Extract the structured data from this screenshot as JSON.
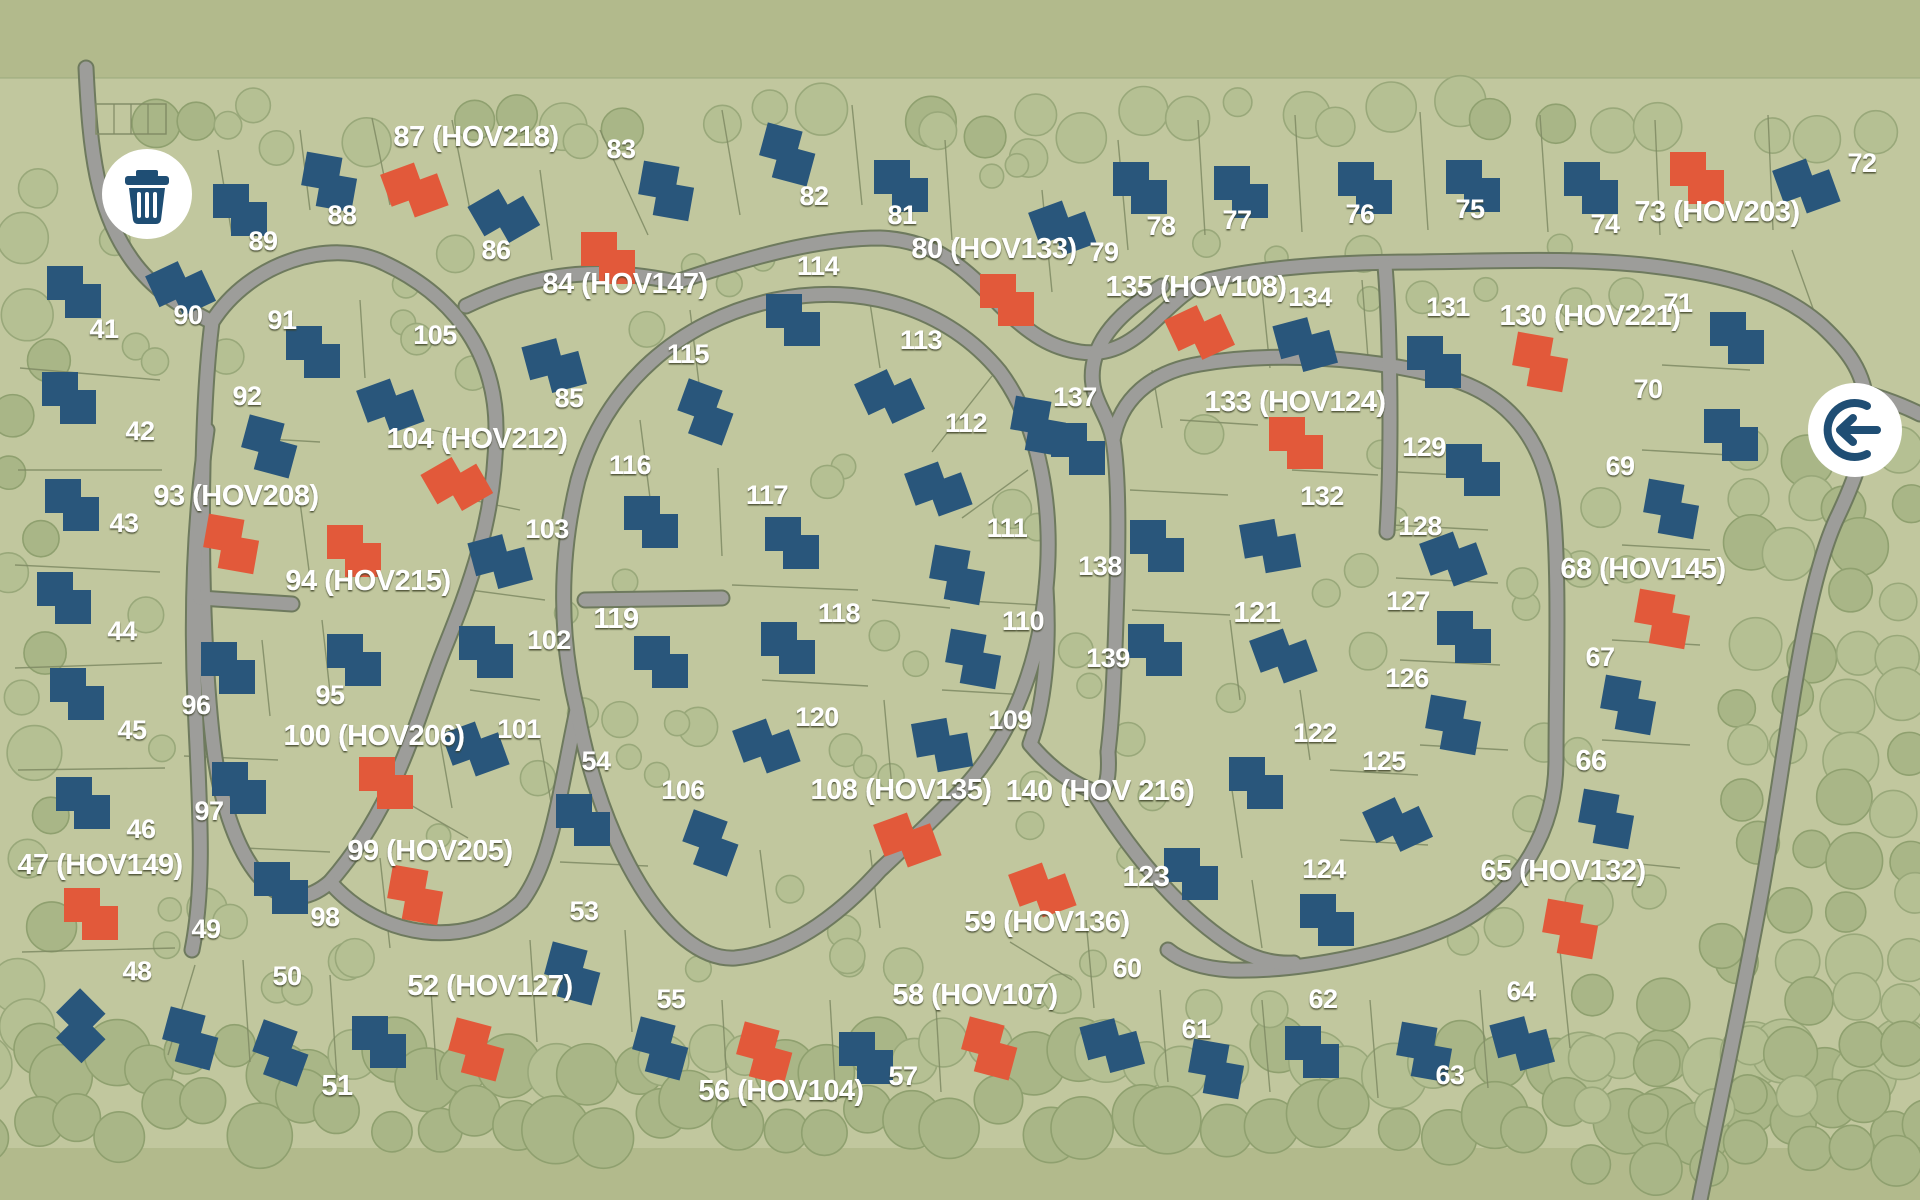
{
  "map_title": "community-site-map",
  "palette": {
    "band_green": "#b2ba8c",
    "land_green": "#c1c79e",
    "parcel_line": "#7f8a64",
    "road_fill": "#9d9d9a",
    "road_casing": "#6e7a5e",
    "house_blue": "#29567b",
    "house_orange": "#e2593a",
    "label_color": "#ffffff",
    "icon_blue": "#1f4e74",
    "icon_circle": "#ffffff",
    "tree_fill": "#b5c093",
    "tree_stroke": "#99a87a",
    "forest_fill": "#a9b687",
    "forest_stroke": "#8fa06f"
  },
  "icons": [
    {
      "name": "trash-icon",
      "x": 147,
      "y": 194,
      "r": 45
    },
    {
      "name": "exit-icon",
      "x": 1855,
      "y": 430,
      "r": 47
    }
  ],
  "lots": [
    {
      "n": "41",
      "bold": false,
      "lx": 104,
      "ly": 338,
      "hx": 80,
      "hy": 292,
      "hr": 0,
      "hc": "blue"
    },
    {
      "n": "42",
      "bold": false,
      "lx": 140,
      "ly": 440,
      "hx": 75,
      "hy": 398,
      "hr": 0,
      "hc": "blue"
    },
    {
      "n": "43",
      "bold": false,
      "lx": 124,
      "ly": 532,
      "hx": 78,
      "hy": 505,
      "hr": 0,
      "hc": "blue"
    },
    {
      "n": "44",
      "bold": false,
      "lx": 122,
      "ly": 640,
      "hx": 70,
      "hy": 598,
      "hr": 0,
      "hc": "blue"
    },
    {
      "n": "45",
      "bold": false,
      "lx": 132,
      "ly": 739,
      "hx": 83,
      "hy": 694,
      "hr": 0,
      "hc": "blue"
    },
    {
      "n": "46",
      "bold": false,
      "lx": 141,
      "ly": 838,
      "hx": 89,
      "hy": 803,
      "hr": 0,
      "hc": "blue"
    },
    {
      "n": "47 (HOV149)",
      "bold": true,
      "lx": 100,
      "ly": 874,
      "hx": 97,
      "hy": 914,
      "hr": 0,
      "hc": "orange"
    },
    {
      "n": "48",
      "bold": false,
      "lx": 137,
      "ly": 980,
      "hx": 85,
      "hy": 1030,
      "hr": 45,
      "hc": "blue"
    },
    {
      "n": "49",
      "bold": false,
      "lx": 206,
      "ly": 938,
      "hx": 196,
      "hy": 1040,
      "hr": 15,
      "hc": "blue"
    },
    {
      "n": "50",
      "bold": false,
      "lx": 287,
      "ly": 985,
      "hx": 286,
      "hy": 1055,
      "hr": 20,
      "hc": "blue"
    },
    {
      "n": "51",
      "bold": true,
      "lx": 337,
      "ly": 1095,
      "hx": 385,
      "hy": 1042,
      "hr": 0,
      "hc": "blue"
    },
    {
      "n": "52 (HOV127)",
      "bold": true,
      "lx": 490,
      "ly": 995,
      "hx": 482,
      "hy": 1051,
      "hr": 15,
      "hc": "orange"
    },
    {
      "n": "53",
      "bold": false,
      "lx": 584,
      "ly": 920,
      "hx": 578,
      "hy": 975,
      "hr": 15,
      "hc": "blue"
    },
    {
      "n": "54",
      "bold": false,
      "lx": 596,
      "ly": 770,
      "hx": 589,
      "hy": 820,
      "hr": 0,
      "hc": "blue"
    },
    {
      "n": "55",
      "bold": false,
      "lx": 671,
      "ly": 1008,
      "hx": 666,
      "hy": 1050,
      "hr": 15,
      "hc": "blue"
    },
    {
      "n": "56 (HOV104)",
      "bold": true,
      "lx": 781,
      "ly": 1100,
      "hx": 770,
      "hy": 1055,
      "hr": 15,
      "hc": "orange"
    },
    {
      "n": "57",
      "bold": false,
      "lx": 903,
      "ly": 1085,
      "hx": 872,
      "hy": 1058,
      "hr": 0,
      "hc": "blue"
    },
    {
      "n": "58 (HOV107)",
      "bold": true,
      "lx": 975,
      "ly": 1004,
      "hx": 995,
      "hy": 1050,
      "hr": 15,
      "hc": "orange"
    },
    {
      "n": "59 (HOV136)",
      "bold": true,
      "lx": 1047,
      "ly": 931,
      "hx": 1048,
      "hy": 888,
      "hr": -20,
      "hc": "orange"
    },
    {
      "n": "60",
      "bold": false,
      "lx": 1127,
      "ly": 977,
      "hx": 1118,
      "hy": 1044,
      "hr": -15,
      "hc": "blue"
    },
    {
      "n": "61",
      "bold": false,
      "lx": 1196,
      "ly": 1038,
      "hx": 1222,
      "hy": 1070,
      "hr": 10,
      "hc": "blue"
    },
    {
      "n": "62",
      "bold": false,
      "lx": 1323,
      "ly": 1008,
      "hx": 1318,
      "hy": 1052,
      "hr": 0,
      "hc": "blue"
    },
    {
      "n": "63",
      "bold": false,
      "lx": 1450,
      "ly": 1084,
      "hx": 1430,
      "hy": 1053,
      "hr": 10,
      "hc": "blue"
    },
    {
      "n": "64",
      "bold": false,
      "lx": 1521,
      "ly": 1000,
      "hx": 1528,
      "hy": 1042,
      "hr": -15,
      "hc": "blue"
    },
    {
      "n": "65 (HOV132)",
      "bold": true,
      "lx": 1563,
      "ly": 880,
      "hx": 1576,
      "hy": 930,
      "hr": 10,
      "hc": "orange"
    },
    {
      "n": "66",
      "bold": true,
      "lx": 1591,
      "ly": 770,
      "hx": 1612,
      "hy": 820,
      "hr": 10,
      "hc": "blue"
    },
    {
      "n": "67",
      "bold": false,
      "lx": 1600,
      "ly": 666,
      "hx": 1634,
      "hy": 706,
      "hr": 10,
      "hc": "blue"
    },
    {
      "n": "68 (HOV145)",
      "bold": true,
      "lx": 1643,
      "ly": 578,
      "hx": 1668,
      "hy": 620,
      "hr": 10,
      "hc": "orange"
    },
    {
      "n": "69",
      "bold": false,
      "lx": 1620,
      "ly": 475,
      "hx": 1677,
      "hy": 510,
      "hr": 10,
      "hc": "blue"
    },
    {
      "n": "70",
      "bold": false,
      "lx": 1648,
      "ly": 398,
      "hx": 1737,
      "hy": 435,
      "hr": 0,
      "hc": "blue"
    },
    {
      "n": "71",
      "bold": false,
      "lx": 1678,
      "ly": 312,
      "hx": 1743,
      "hy": 338,
      "hr": 0,
      "hc": "blue"
    },
    {
      "n": "72",
      "bold": false,
      "lx": 1862,
      "ly": 172,
      "hx": 1812,
      "hy": 184,
      "hr": -20,
      "hc": "blue"
    },
    {
      "n": "73 (HOV203)",
      "bold": true,
      "lx": 1717,
      "ly": 221,
      "hx": 1703,
      "hy": 178,
      "hr": 0,
      "hc": "orange"
    },
    {
      "n": "74",
      "bold": false,
      "lx": 1605,
      "ly": 233,
      "hx": 1597,
      "hy": 188,
      "hr": 0,
      "hc": "blue"
    },
    {
      "n": "75",
      "bold": false,
      "lx": 1470,
      "ly": 218,
      "hx": 1479,
      "hy": 186,
      "hr": 0,
      "hc": "blue"
    },
    {
      "n": "76",
      "bold": false,
      "lx": 1360,
      "ly": 223,
      "hx": 1371,
      "hy": 188,
      "hr": 0,
      "hc": "blue"
    },
    {
      "n": "77",
      "bold": false,
      "lx": 1237,
      "ly": 229,
      "hx": 1247,
      "hy": 192,
      "hr": 0,
      "hc": "blue"
    },
    {
      "n": "78",
      "bold": false,
      "lx": 1161,
      "ly": 235,
      "hx": 1146,
      "hy": 188,
      "hr": 0,
      "hc": "blue"
    },
    {
      "n": "79",
      "bold": false,
      "lx": 1104,
      "ly": 261,
      "hx": 1068,
      "hy": 226,
      "hr": -20,
      "hc": "blue"
    },
    {
      "n": "80 (HOV133)",
      "bold": true,
      "lx": 994,
      "ly": 258,
      "hx": 1013,
      "hy": 300,
      "hr": 0,
      "hc": "orange"
    },
    {
      "n": "81",
      "bold": false,
      "lx": 902,
      "ly": 224,
      "hx": 907,
      "hy": 186,
      "hr": 0,
      "hc": "blue"
    },
    {
      "n": "82",
      "bold": false,
      "lx": 814,
      "ly": 205,
      "hx": 793,
      "hy": 156,
      "hr": 15,
      "hc": "blue"
    },
    {
      "n": "83",
      "bold": false,
      "lx": 621,
      "ly": 158,
      "hx": 672,
      "hy": 192,
      "hr": 10,
      "hc": "blue"
    },
    {
      "n": "84 (HOV147)",
      "bold": true,
      "lx": 625,
      "ly": 293,
      "hx": 614,
      "hy": 258,
      "hr": 0,
      "hc": "orange"
    },
    {
      "n": "85",
      "bold": false,
      "lx": 569,
      "ly": 407,
      "hx": 560,
      "hy": 364,
      "hr": -15,
      "hc": "blue"
    },
    {
      "n": "86",
      "bold": false,
      "lx": 496,
      "ly": 259,
      "hx": 509,
      "hy": 213,
      "hr": -30,
      "hc": "blue"
    },
    {
      "n": "87 (HOV218)",
      "bold": true,
      "lx": 476,
      "ly": 146,
      "hx": 420,
      "hy": 188,
      "hr": -20,
      "hc": "orange"
    },
    {
      "n": "88",
      "bold": false,
      "lx": 342,
      "ly": 224,
      "hx": 335,
      "hy": 183,
      "hr": 10,
      "hc": "blue"
    },
    {
      "n": "89",
      "bold": false,
      "lx": 263,
      "ly": 250,
      "hx": 246,
      "hy": 210,
      "hr": 0,
      "hc": "blue"
    },
    {
      "n": "90",
      "bold": false,
      "lx": 188,
      "ly": 324,
      "hx": 186,
      "hy": 286,
      "hr": -25,
      "hc": "blue"
    },
    {
      "n": "91",
      "bold": false,
      "lx": 282,
      "ly": 329,
      "hx": 319,
      "hy": 352,
      "hr": 0,
      "hc": "blue"
    },
    {
      "n": "92",
      "bold": false,
      "lx": 247,
      "ly": 405,
      "hx": 275,
      "hy": 448,
      "hr": 15,
      "hc": "blue"
    },
    {
      "n": "93 (HOV208)",
      "bold": true,
      "lx": 236,
      "ly": 505,
      "hx": 237,
      "hy": 545,
      "hr": 10,
      "hc": "orange"
    },
    {
      "n": "94 (HOV215)",
      "bold": true,
      "lx": 368,
      "ly": 590,
      "hx": 360,
      "hy": 551,
      "hr": 0,
      "hc": "orange"
    },
    {
      "n": "95",
      "bold": false,
      "lx": 330,
      "ly": 704,
      "hx": 360,
      "hy": 660,
      "hr": 0,
      "hc": "blue"
    },
    {
      "n": "96",
      "bold": false,
      "lx": 196,
      "ly": 714,
      "hx": 234,
      "hy": 668,
      "hr": 0,
      "hc": "blue"
    },
    {
      "n": "97",
      "bold": false,
      "lx": 209,
      "ly": 820,
      "hx": 245,
      "hy": 788,
      "hr": 0,
      "hc": "blue"
    },
    {
      "n": "98",
      "bold": false,
      "lx": 325,
      "ly": 926,
      "hx": 287,
      "hy": 888,
      "hr": 0,
      "hc": "blue"
    },
    {
      "n": "99 (HOV205)",
      "bold": true,
      "lx": 430,
      "ly": 860,
      "hx": 421,
      "hy": 896,
      "hr": 10,
      "hc": "orange"
    },
    {
      "n": "100 (HOV206)",
      "bold": true,
      "lx": 374,
      "ly": 745,
      "hx": 392,
      "hy": 783,
      "hr": 0,
      "hc": "orange"
    },
    {
      "n": "101",
      "bold": false,
      "lx": 519,
      "ly": 738,
      "hx": 481,
      "hy": 747,
      "hr": -20,
      "hc": "blue"
    },
    {
      "n": "102",
      "bold": false,
      "lx": 549,
      "ly": 649,
      "hx": 492,
      "hy": 652,
      "hr": 0,
      "hc": "blue"
    },
    {
      "n": "103",
      "bold": false,
      "lx": 547,
      "ly": 538,
      "hx": 506,
      "hy": 560,
      "hr": -15,
      "hc": "blue"
    },
    {
      "n": "104 (HOV212)",
      "bold": true,
      "lx": 477,
      "ly": 448,
      "hx": 462,
      "hy": 481,
      "hr": -30,
      "hc": "orange"
    },
    {
      "n": "105",
      "bold": false,
      "lx": 435,
      "ly": 344,
      "hx": 396,
      "hy": 404,
      "hr": -20,
      "hc": "blue"
    },
    {
      "n": "106",
      "bold": false,
      "lx": 683,
      "ly": 799,
      "hx": 716,
      "hy": 845,
      "hr": 20,
      "hc": "blue"
    },
    {
      "n": "108 (HOV135)",
      "bold": true,
      "lx": 901,
      "ly": 799,
      "hx": 913,
      "hy": 838,
      "hr": -20,
      "hc": "orange"
    },
    {
      "n": "109",
      "bold": false,
      "lx": 1010,
      "ly": 729,
      "hx": 948,
      "hy": 744,
      "hr": -10,
      "hc": "blue"
    },
    {
      "n": "110",
      "bold": false,
      "lx": 1023,
      "ly": 630,
      "hx": 979,
      "hy": 660,
      "hr": 10,
      "hc": "blue"
    },
    {
      "n": "111",
      "bold": false,
      "lx": 1007,
      "ly": 537,
      "hx": 963,
      "hy": 576,
      "hr": 10,
      "hc": "blue"
    },
    {
      "n": "112",
      "bold": false,
      "lx": 966,
      "ly": 432,
      "hx": 944,
      "hy": 487,
      "hr": -20,
      "hc": "blue"
    },
    {
      "n": "113",
      "bold": false,
      "lx": 921,
      "ly": 349,
      "hx": 895,
      "hy": 394,
      "hr": -25,
      "hc": "blue"
    },
    {
      "n": "114",
      "bold": false,
      "lx": 818,
      "ly": 275,
      "hx": 799,
      "hy": 320,
      "hr": 0,
      "hc": "blue"
    },
    {
      "n": "115",
      "bold": false,
      "lx": 688,
      "ly": 363,
      "hx": 711,
      "hy": 414,
      "hr": 20,
      "hc": "blue"
    },
    {
      "n": "116",
      "bold": false,
      "lx": 630,
      "ly": 474,
      "hx": 657,
      "hy": 522,
      "hr": 0,
      "hc": "blue"
    },
    {
      "n": "117",
      "bold": false,
      "lx": 767,
      "ly": 504,
      "hx": 798,
      "hy": 543,
      "hr": 0,
      "hc": "blue"
    },
    {
      "n": "118",
      "bold": false,
      "lx": 839,
      "ly": 622,
      "hx": 794,
      "hy": 648,
      "hr": 0,
      "hc": "blue"
    },
    {
      "n": "119",
      "bold": true,
      "lx": 616,
      "ly": 628,
      "hx": 667,
      "hy": 662,
      "hr": 0,
      "hc": "blue"
    },
    {
      "n": "120",
      "bold": false,
      "lx": 817,
      "ly": 726,
      "hx": 772,
      "hy": 744,
      "hr": -20,
      "hc": "blue"
    },
    {
      "n": "121",
      "bold": true,
      "lx": 1257,
      "ly": 622,
      "hx": 1289,
      "hy": 654,
      "hr": -20,
      "hc": "blue"
    },
    {
      "n": "122",
      "bold": false,
      "lx": 1315,
      "ly": 742,
      "hx": 1262,
      "hy": 783,
      "hr": 0,
      "hc": "blue"
    },
    {
      "n": "123",
      "bold": true,
      "lx": 1146,
      "ly": 886,
      "hx": 1197,
      "hy": 874,
      "hr": 0,
      "hc": "blue"
    },
    {
      "n": "124",
      "bold": false,
      "lx": 1324,
      "ly": 878,
      "hx": 1333,
      "hy": 920,
      "hr": 0,
      "hc": "blue"
    },
    {
      "n": "125",
      "bold": false,
      "lx": 1384,
      "ly": 770,
      "hx": 1403,
      "hy": 822,
      "hr": -25,
      "hc": "blue"
    },
    {
      "n": "126",
      "bold": false,
      "lx": 1407,
      "ly": 687,
      "hx": 1459,
      "hy": 726,
      "hr": 10,
      "hc": "blue"
    },
    {
      "n": "127",
      "bold": false,
      "lx": 1408,
      "ly": 610,
      "hx": 1470,
      "hy": 637,
      "hr": 0,
      "hc": "blue"
    },
    {
      "n": "128",
      "bold": false,
      "lx": 1420,
      "ly": 535,
      "hx": 1459,
      "hy": 557,
      "hr": -20,
      "hc": "blue"
    },
    {
      "n": "129",
      "bold": false,
      "lx": 1424,
      "ly": 456,
      "hx": 1479,
      "hy": 470,
      "hr": 0,
      "hc": "blue"
    },
    {
      "n": "130 (HOV221)",
      "bold": true,
      "lx": 1590,
      "ly": 325,
      "hx": 1546,
      "hy": 363,
      "hr": 10,
      "hc": "orange"
    },
    {
      "n": "131",
      "bold": false,
      "lx": 1448,
      "ly": 316,
      "hx": 1440,
      "hy": 362,
      "hr": 0,
      "hc": "blue"
    },
    {
      "n": "132",
      "bold": false,
      "lx": 1322,
      "ly": 505,
      "hx": 1276,
      "hy": 545,
      "hr": -10,
      "hc": "blue"
    },
    {
      "n": "133 (HOV124)",
      "bold": true,
      "lx": 1295,
      "ly": 411,
      "hx": 1302,
      "hy": 443,
      "hr": 0,
      "hc": "orange"
    },
    {
      "n": "134",
      "bold": false,
      "lx": 1310,
      "ly": 306,
      "hx": 1311,
      "hy": 343,
      "hr": -15,
      "hc": "blue"
    },
    {
      "n": "135 (HOV108)",
      "bold": true,
      "lx": 1196,
      "ly": 296,
      "hx": 1205,
      "hy": 330,
      "hr": -25,
      "hc": "orange"
    },
    {
      "n": "",
      "bold": false,
      "lx": 0,
      "ly": 0,
      "hx": 1044,
      "hy": 427,
      "hr": 10,
      "hc": "blue"
    },
    {
      "n": "137",
      "bold": false,
      "lx": 1075,
      "ly": 406,
      "hx": 1084,
      "hy": 449,
      "hr": 0,
      "hc": "blue"
    },
    {
      "n": "138",
      "bold": false,
      "lx": 1100,
      "ly": 575,
      "hx": 1163,
      "hy": 546,
      "hr": 0,
      "hc": "blue"
    },
    {
      "n": "139",
      "bold": false,
      "lx": 1108,
      "ly": 667,
      "hx": 1161,
      "hy": 650,
      "hr": 0,
      "hc": "blue"
    },
    {
      "n": "140 (HOV 216)",
      "bold": true,
      "lx": 1100,
      "ly": 800,
      "hx": null,
      "hy": null,
      "hr": 0,
      "hc": null
    }
  ]
}
